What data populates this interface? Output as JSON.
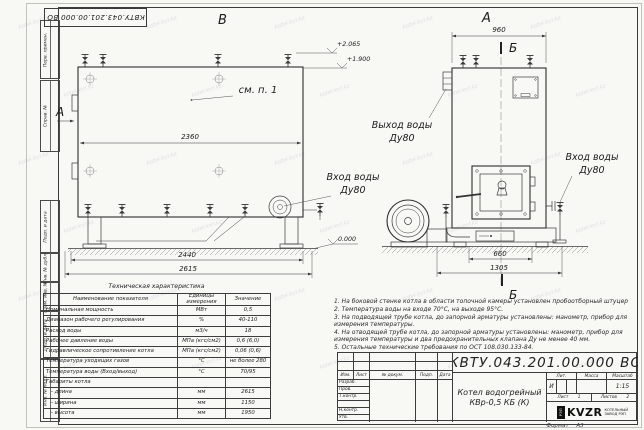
{
  "doc_code": "КВТУ.043.201.00.000 ВО",
  "stamp_top": "КВТУ.043.201.00.000 ВО",
  "views": {
    "a": "А",
    "b": "Б",
    "v": "В",
    "see_note": "см. п. 1"
  },
  "labels": {
    "outlet_line1": "Выход воды",
    "outlet_line2": "Ду80",
    "inlet_side_line1": "Вход воды",
    "inlet_side_line2": "Ду80",
    "inlet_front_line1": "Вход воды",
    "inlet_front_line2": "Ду80"
  },
  "elevations": {
    "top": "+2.065",
    "mid": "+1.900",
    "zero": "0.000"
  },
  "dimensions": {
    "side_top": "2360",
    "side_mid": "2440",
    "side_bottom": "2615",
    "front_top": "960",
    "front_660": "660",
    "front_1305": "1305"
  },
  "frame": {
    "columns": [
      "Перв. примен.",
      "Справ. №",
      "Подп. и дата",
      "Инв. № дубл.",
      "Взам. инв. №",
      "Подп. и дата",
      "Инв. № подл."
    ]
  },
  "tech_table": {
    "title": "Техническая характеристика",
    "headers": [
      "Наименование показателя",
      "Единицы измерения",
      "Значение"
    ],
    "rows": [
      [
        "Номинальная мощность",
        "МВт",
        "0,5"
      ],
      [
        "Диапазон рабочего регулирования",
        "%",
        "40-110"
      ],
      [
        "Расход воды",
        "м3/ч",
        "18"
      ],
      [
        "Рабочее давление воды",
        "МПа (кгс/см2)",
        "0,6 (6,0)"
      ],
      [
        "Гидравлическое сопротивление котла",
        "МПа (кгс/см2)",
        "0,06 (0,6)"
      ],
      [
        "Температура уходящих газов",
        "°С",
        "не более 280"
      ],
      [
        "Температура воды (Вход/выход)",
        "°С",
        "70/95"
      ],
      [
        "Габариты котла",
        "",
        ""
      ],
      [
        "   - длина",
        "мм",
        "2615"
      ],
      [
        "   - ширина",
        "мм",
        "1150"
      ],
      [
        "   - высота",
        "мм",
        "1950"
      ]
    ]
  },
  "notes": [
    "1. На боковой стенке котла в области топочной камеры установлен пробоотборный штуцер",
    "2. Температура воды на входе 70°С, на выходе 95°С.",
    "3. На подводящей трубе котла, до запорной арматуры установлены: манометр, прибор для измерения температуры.",
    "4. На отводящей трубе котла, до запорной арматуры установлены: манометр, прибор для измерения температуры и два предохранительных клапана Ду не менее 40 мм.",
    "5. Остальные технические требования по ОСТ 108.030.133-84."
  ],
  "title_block": {
    "designation": "КВТУ.043.201.00.000 ВО",
    "header_cols": [
      "Изм.",
      "Лист",
      "№ докум.",
      "Подп.",
      "Дата"
    ],
    "row_labels": [
      "Разраб.",
      "Пров.",
      "Т.контр.",
      "",
      "Н.контр.",
      "Утв."
    ],
    "product_name_line1": "Котел водогрейный",
    "product_name_line2": "КВр-0,5 КБ (К)",
    "lit_label": "Лит.",
    "mass_label": "Масса",
    "scale_label": "Масштаб",
    "lit_value": "И",
    "scale_value": "1:15",
    "sheet_label": "Лист",
    "sheet_value": "1",
    "sheets_label": "Листов",
    "sheets_value": "2",
    "logo_mark_text": "РЭП",
    "logo_text": "KVZR",
    "company_line1": "КОТЕЛЬНЫЙ",
    "company_line2": "ЗАВОД РЭП",
    "format_label": "Формат",
    "format_value": "А3"
  },
  "watermark": "kotel-kvr.kz"
}
